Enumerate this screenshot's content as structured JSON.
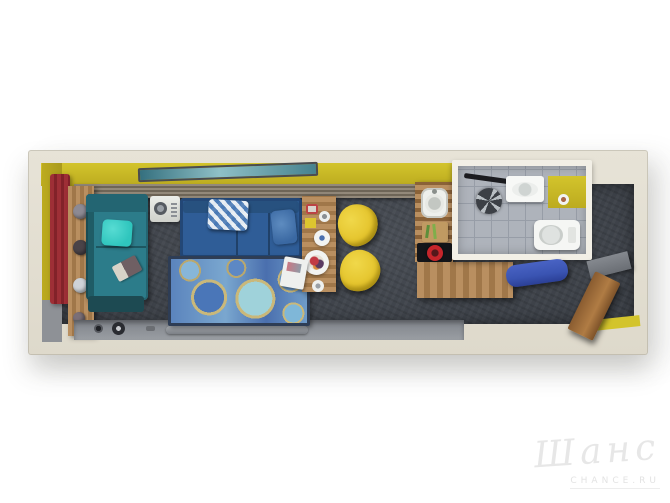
{
  "scene": {
    "title": "3D top-down floor plan render of a narrow studio apartment",
    "rooms": [
      {
        "name": "living-area",
        "label": "living / sleeping area"
      },
      {
        "name": "kitchen",
        "label": "kitchenette"
      },
      {
        "name": "bathroom",
        "label": "bathroom"
      },
      {
        "name": "entry",
        "label": "entry hall"
      }
    ],
    "items": [
      "teal daybed with cyan pillow and tablet",
      "dark teal ottoman",
      "white appliance",
      "blue sofa with lattice-pattern pillow",
      "blue circle-pattern rug",
      "wooden dining table with plates and food",
      "two yellow shell chairs",
      "L-shaped wooden kitchen counter",
      "white sink",
      "cutting board with greens",
      "black cooktop with red pot",
      "shower fixture",
      "wall-hung washbasin",
      "toilet",
      "yellow accent walls",
      "red curtain panel",
      "wall shelf with round decor",
      "media ledge with speakers and soundbar",
      "blue entry bench",
      "gray entry shelf",
      "open wooden door",
      "teal window strip"
    ]
  },
  "watermark": {
    "title": "Шанс",
    "subtitle": "CHANCE.RU"
  },
  "palette": {
    "bg": "#ffffff",
    "wall-cut": "#e7e3d7",
    "accent-yellow": "#bcab1f",
    "accent-yellow2": "#d3c42c",
    "floor-dark": "#41464e",
    "wood": "#a07749",
    "wood-dark": "#8a6238",
    "wood-light": "#b98f60",
    "sofa-blue": "#2f5d97",
    "sofa-blue-dark": "#234776",
    "daybed-teal": "#2c7c8a",
    "daybed-teal-dark": "#1f5c66",
    "pillow-cyan": "#2fc5bd",
    "chair-yellow": "#e5c52e",
    "chair-yellow-dark": "#c3a51a",
    "curtain-red": "#9e2f36",
    "tile-gray": "#aeb3bb",
    "tile-line": "#979da7",
    "wall-gray": "#8e9196",
    "bench-blue": "#3a54b2",
    "rug-border": "#2e3d55",
    "cooktop-black": "#141519",
    "pot-red": "#c6252b",
    "watermark-gray": "#e7e7e7"
  }
}
